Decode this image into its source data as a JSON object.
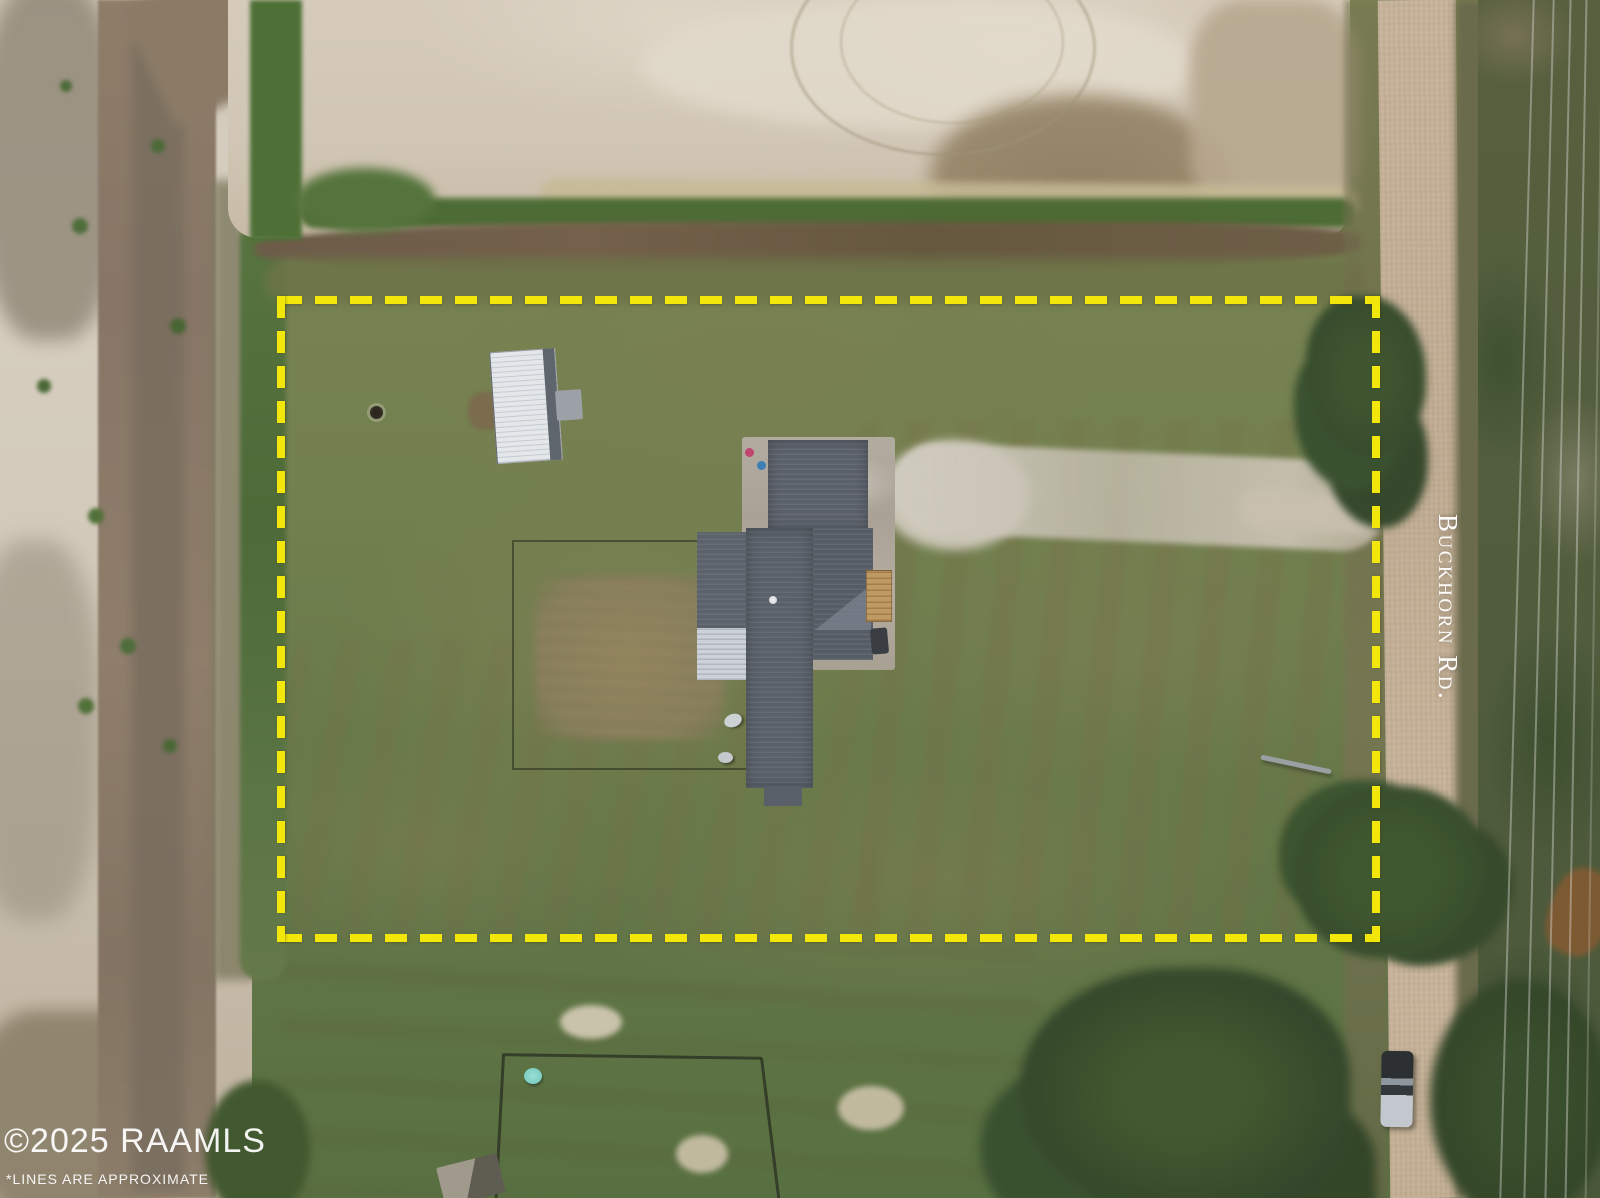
{
  "labels": {
    "road_name": "Buckhorn Rd.",
    "watermark": "©2025 RAAMLS",
    "disclaimer": "*LINES ARE APPROXIMATE"
  },
  "colors": {
    "boundary_yellow": "#F2E60A",
    "house_roof_gray": "#596069",
    "roof_silver_section": "#CDD2D9",
    "shed_roof_white": "#E4E7EA",
    "concrete_pad": "#B2ABA0",
    "deck_wood": "#BF9A62",
    "grass_green": "#73804F",
    "sand_pad_beige": "#D3C8B7",
    "mud_road_brown": "#8A7A66",
    "gravel_road_tan": "#C4B196",
    "tree_green": "#3A5130",
    "watermark_white": "#FFFFFF"
  },
  "scene": {
    "type": "aerial drone photo of rural property listing",
    "features": [
      "yellow dashed property boundary rectangle",
      "house with dark gray metal roof on concrete pad",
      "white metal-roof shed",
      "fenced garden plot with bush",
      "gravel driveway leading to road",
      "vertical dirt road on right labeled Buckhorn Rd.",
      "vehicle parked on road",
      "excavated sand pad across top",
      "muddy farm road on left",
      "fenced paddock and small building at bottom",
      "power lines along right edge",
      "MLS watermark bottom left"
    ]
  }
}
